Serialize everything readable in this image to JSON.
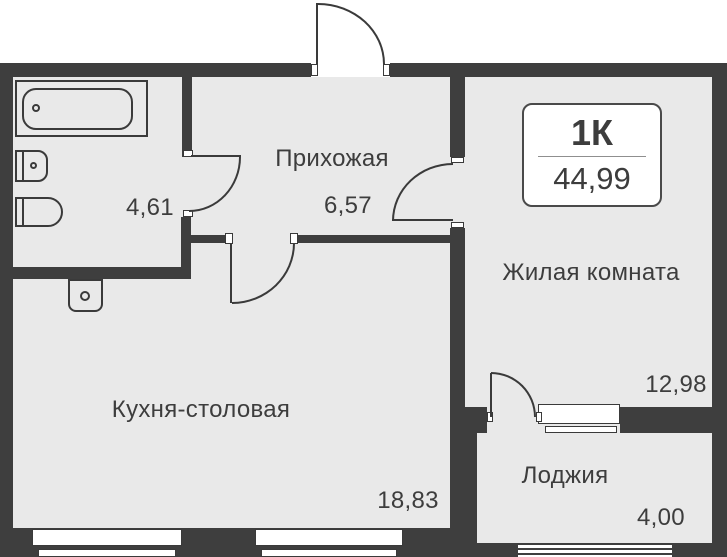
{
  "unit_card": {
    "type_label": "1К",
    "area_label": "44,99"
  },
  "rooms": [
    {
      "id": "hallway",
      "name": "Прихожая",
      "area": "6,57"
    },
    {
      "id": "bathroom",
      "name": "",
      "area": "4,61"
    },
    {
      "id": "living-room",
      "name": "Жилая комната",
      "area": "12,98"
    },
    {
      "id": "kitchen-dining",
      "name": "Кухня-столовая",
      "area": "18,83"
    },
    {
      "id": "loggia",
      "name": "Лоджия",
      "area": "4,00"
    }
  ],
  "fixtures": [
    "bathtub-icon",
    "sink-icon",
    "toilet-icon",
    "washing-machine-icon"
  ],
  "openings": [
    "entrance-door",
    "bathroom-door",
    "kitchen-door",
    "living-room-door",
    "loggia-door",
    "kitchen-window-left",
    "kitchen-window-right",
    "balcony-window-block",
    "loggia-glazing"
  ],
  "colors": {
    "wall": "#3e3e3e",
    "room_fill": "#e9e9e9",
    "background": "#ffffff",
    "text": "#3d3d3d"
  }
}
